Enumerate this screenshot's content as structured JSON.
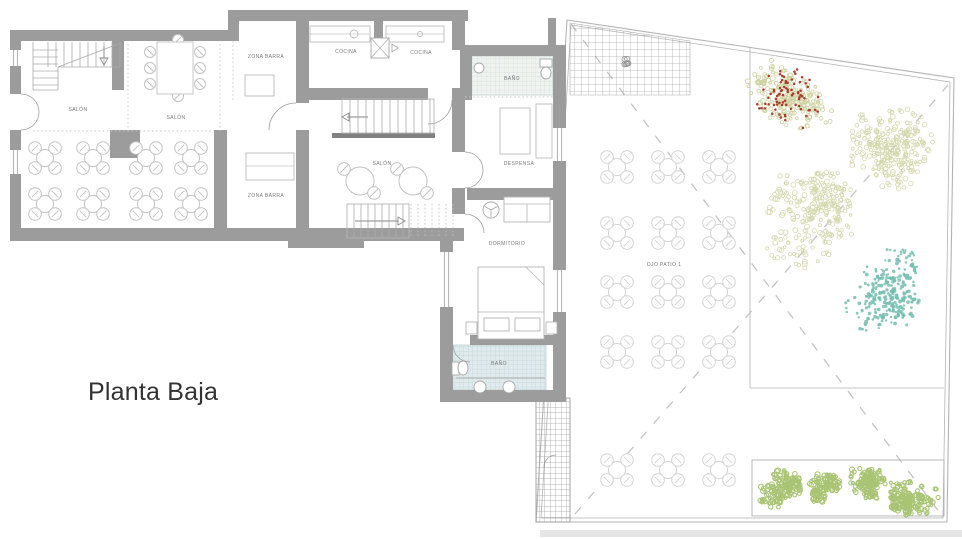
{
  "title": {
    "text": "Planta Baja"
  },
  "canvas": {
    "w": 962,
    "h": 539,
    "bg": "#ffffff"
  },
  "palette": {
    "wall": "#9c9c9c",
    "wall_dark": "#818181",
    "outline": "#b3b3b3",
    "furniture": "#c2c2c2",
    "furniture_light": "#d3d3d3",
    "label": "#787878",
    "dash": "#c3c3c3",
    "dotted": "#c6c6c6",
    "hatch": "#a5a5a5",
    "walk_hatch": "#9a9a9a",
    "tile1_bg": "#eef2f0",
    "tile1_line": "#ccd8d3",
    "tile2_bg": "#dfeaec",
    "tile2_line": "#b9cfd4",
    "band": "#e6e6e6",
    "arc": "#9f9f9f",
    "tree_olive": "#cdd2a0",
    "tree_olive_light": "#d5d9ad",
    "tree_red": "#a93a2c",
    "tree_teal": "#74bdb0",
    "bush_green": "#a9c474",
    "title_color": "#333333"
  },
  "labels": [
    {
      "text": "SALÓN",
      "x": 78,
      "y": 111
    },
    {
      "text": "SALÓN",
      "x": 176,
      "y": 119
    },
    {
      "text": "ZONA BARRA",
      "x": 266,
      "y": 58
    },
    {
      "text": "ZONA BARRA",
      "x": 266,
      "y": 197
    },
    {
      "text": "COCINA",
      "x": 346,
      "y": 53
    },
    {
      "text": "COCINA",
      "x": 421,
      "y": 54
    },
    {
      "text": "BAÑO",
      "x": 512,
      "y": 80
    },
    {
      "text": "DESPENSA",
      "x": 519,
      "y": 165
    },
    {
      "text": "SALÓN",
      "x": 382,
      "y": 165
    },
    {
      "text": "DORMITORIO",
      "x": 507,
      "y": 245
    },
    {
      "text": "BAÑO",
      "x": 499,
      "y": 365
    },
    {
      "text": "OJO PATIO 1",
      "x": 664,
      "y": 266
    }
  ],
  "building": {
    "white_areas": [
      [
        10,
        30,
        286,
        211
      ],
      [
        228,
        10,
        240,
        90
      ],
      [
        296,
        88,
        169,
        153
      ],
      [
        432,
        45,
        134,
        357
      ]
    ],
    "walls": [
      [
        10,
        30,
        221,
        11
      ],
      [
        228,
        10,
        240,
        11
      ],
      [
        228,
        10,
        11,
        31
      ],
      [
        10,
        41,
        11,
        191
      ],
      [
        10,
        228,
        285,
        13
      ],
      [
        288,
        228,
        76,
        20
      ],
      [
        112,
        41,
        12,
        49
      ],
      [
        110,
        130,
        30,
        28
      ],
      [
        214,
        130,
        13,
        98
      ],
      [
        296,
        21,
        13,
        207
      ],
      [
        374,
        10,
        9,
        31
      ],
      [
        452,
        10,
        13,
        40
      ],
      [
        300,
        88,
        162,
        12
      ],
      [
        300,
        228,
        164,
        13
      ],
      [
        452,
        95,
        13,
        57
      ],
      [
        452,
        188,
        13,
        26
      ],
      [
        460,
        45,
        106,
        11
      ],
      [
        553,
        56,
        13,
        346
      ],
      [
        460,
        56,
        12,
        44
      ],
      [
        467,
        188,
        86,
        12
      ],
      [
        440,
        232,
        13,
        170
      ],
      [
        470,
        335,
        84,
        10
      ],
      [
        440,
        390,
        126,
        12
      ],
      [
        548,
        18,
        8,
        28
      ]
    ],
    "dark_strips": [
      [
        332,
        133,
        103,
        5
      ]
    ],
    "door_gaps": [
      [
        296,
        103,
        13,
        27
      ],
      [
        428,
        88,
        24,
        12
      ],
      [
        10,
        94,
        11,
        36
      ]
    ],
    "windows": [
      {
        "r": [
          10,
          50,
          11,
          16
        ],
        "o": "v"
      },
      {
        "r": [
          10,
          150,
          11,
          24
        ],
        "o": "v"
      },
      {
        "r": [
          553,
          128,
          13,
          33
        ],
        "o": "v"
      },
      {
        "r": [
          553,
          270,
          13,
          42
        ],
        "o": "v"
      },
      {
        "r": [
          440,
          252,
          13,
          55
        ],
        "o": "v"
      }
    ],
    "door_arcs": [
      "M21,94 A18,18 0 0 1 39,112",
      "M21,130 A18,18 0 0 0 39,112",
      "M296,103 A27,27 0 0 0 269,130",
      "M452,100 A24,24 0 0 1 428,124",
      "M465,152 A18,18 0 0 1 483,170",
      "M465,188 A18,18 0 0 0 483,170",
      "M465,214 A19,19 0 0 1 484,233",
      "M453,345 A17,17 0 0 0 470,362",
      "M556,455 A12,12 0 0 0 544,467"
    ],
    "dotted_lines": [
      [
        33,
        131,
        214,
        131
      ],
      [
        128,
        44,
        128,
        131
      ],
      [
        220,
        44,
        220,
        131
      ],
      [
        233,
        41,
        233,
        100
      ],
      [
        465,
        97,
        553,
        97
      ]
    ],
    "tiles": [
      {
        "r": [
          467,
          56,
          86,
          39
        ],
        "pat": "tile1"
      },
      {
        "r": [
          452,
          345,
          94,
          45
        ],
        "pat": "tile2"
      }
    ],
    "stairs": {
      "winder": {
        "v_treads": {
          "x0": 48,
          "x1": 112,
          "step": 8,
          "y0": 42,
          "y1": 67
        },
        "h_treads": {
          "y0": 50,
          "y1": 85,
          "step": 7,
          "x0": 33,
          "x1": 58
        },
        "outline": [
          [
            33,
            42,
            33,
            90
          ],
          [
            33,
            90,
            58,
            90
          ],
          [
            58,
            67,
            58,
            90
          ],
          [
            58,
            67,
            120,
            67
          ],
          [
            120,
            42,
            120,
            67
          ]
        ],
        "diag": [
          58,
          67,
          118,
          44
        ],
        "arrow": {
          "line": [
            104,
            46,
            104,
            58
          ],
          "tri": "100,58 108,58 104,65"
        }
      },
      "upper": {
        "box": [
          342,
          99,
          92,
          34
        ],
        "treads": {
          "x0": 350,
          "x1": 430,
          "step": 8
        },
        "arrow": {
          "line": [
            347,
            117,
            368,
            117
          ],
          "tri": "349,113 349,121 342,117"
        }
      },
      "lower": {
        "box": [
          347,
          204,
          62,
          34
        ],
        "treads": {
          "x0": 354,
          "x1": 404,
          "step": 7
        },
        "dotted": {
          "x0": 411,
          "x1": 453,
          "step": 7,
          "y0": 204,
          "y1": 238
        },
        "arrow": {
          "line": [
            355,
            221,
            398,
            221
          ],
          "tri": "398,217 398,225 405,221"
        }
      }
    },
    "furniture": {
      "tables4_indoor": [
        [
          45,
          158
        ],
        [
          93,
          158
        ],
        [
          146,
          158
        ],
        [
          191,
          158
        ],
        [
          45,
          204
        ],
        [
          93,
          204
        ],
        [
          146,
          204
        ],
        [
          191,
          204
        ]
      ],
      "tables2": [
        [
          360,
          181
        ],
        [
          413,
          181
        ]
      ],
      "long_table": {
        "rect": [
          157,
          42,
          36,
          52
        ],
        "chairs_left_x": 150,
        "chairs_right_x": 200,
        "chairs_y": [
          52,
          68,
          84
        ],
        "end_chairs": [
          [
            178,
            40
          ],
          [
            178,
            96
          ]
        ]
      },
      "counters": [
        [
          245,
          75,
          29,
          21
        ],
        [
          246,
          153,
          48,
          27
        ],
        [
          310,
          26,
          60,
          16
        ],
        [
          386,
          26,
          58,
          16
        ],
        [
          500,
          108,
          30,
          46
        ],
        [
          536,
          104,
          16,
          54
        ]
      ],
      "counter_lines": [
        [
          246,
          166,
          294,
          166
        ],
        [
          310,
          34,
          370,
          34
        ],
        [
          386,
          34,
          444,
          34
        ]
      ],
      "appliances": [
        {
          "c": [
            354,
            34
          ],
          "r": 4
        },
        {
          "c": [
            420,
            34
          ],
          "r": 2.5
        }
      ],
      "door_icon": {
        "rect": [
          371,
          38,
          18,
          20
        ],
        "x1": [
          371,
          38,
          389,
          58
        ],
        "x2": [
          389,
          38,
          371,
          58
        ],
        "tri": "392,44 398,48 392,52"
      },
      "bed": {
        "rect": [
          478,
          267,
          66,
          72
        ],
        "pillows": [
          [
            484,
            318,
            25,
            13
          ],
          [
            515,
            318,
            25,
            13
          ]
        ],
        "line": [
          478,
          312,
          544,
          312
        ],
        "fold": [
          526,
          267,
          544,
          285
        ],
        "stands": [
          [
            466,
            322,
            11,
            12
          ],
          [
            546,
            322,
            11,
            12
          ]
        ]
      },
      "sofa": {
        "rect": [
          504,
          197,
          46,
          25
        ],
        "back": [
          504,
          204,
          550,
          204
        ],
        "split": [
          527,
          204,
          527,
          222
        ]
      },
      "fan": {
        "c": [
          491,
          210
        ],
        "r": 8
      },
      "bath1": {
        "sink": {
          "c": [
            479,
            68
          ],
          "r": 5
        },
        "toilet_tank": [
          540,
          59,
          12,
          8
        ],
        "toilet_bowl": {
          "c": [
            546,
            73
          ],
          "rx": 5,
          "ry": 6
        }
      },
      "bath2": {
        "counter": [
          456,
          378,
          545,
          378
        ],
        "sinks": [
          [
            480,
            387
          ],
          [
            509,
            387
          ]
        ],
        "toilet_tank": [
          452,
          362,
          7,
          13
        ],
        "toilet_bowl": {
          "c": [
            463,
            368
          ],
          "rx": 5,
          "ry": 7
        }
      }
    }
  },
  "patio": {
    "outline_outer": "567,20 954,78 947,522 536,522",
    "outline_inner": "571,25 950,82 943,518 541,518",
    "garden_lines": [
      [
        750,
        47,
        750,
        388
      ],
      [
        750,
        388,
        944,
        388
      ]
    ],
    "dash_lines": [
      [
        571,
        24,
        943,
        517
      ],
      [
        575,
        514,
        948,
        85
      ]
    ],
    "terrace_hatch": "570,23 690,41 690,95 570,95",
    "flower": {
      "c": [
        628,
        62
      ],
      "r": 7
    },
    "walkway": [
      536,
      398,
      34,
      124
    ],
    "planter": [
      752,
      460,
      192,
      56
    ],
    "bottom_band": [
      540,
      530,
      422,
      7
    ],
    "table_cols": [
      617,
      668,
      719
    ],
    "table_rows": [
      167,
      233,
      292,
      352,
      470
    ]
  },
  "trees": [
    {
      "cx": 790,
      "cy": 100,
      "r": 46,
      "type": "mixed",
      "seed": 7
    },
    {
      "cx": 894,
      "cy": 148,
      "r": 54,
      "type": "ring",
      "seed": 11
    },
    {
      "cx": 812,
      "cy": 220,
      "r": 54,
      "type": "ring",
      "seed": 23
    },
    {
      "cx": 886,
      "cy": 290,
      "r": 48,
      "type": "dots",
      "seed": 31
    }
  ],
  "bushes": [
    {
      "cx": 781,
      "cy": 487,
      "r": 25,
      "seed": 41
    },
    {
      "cx": 823,
      "cy": 489,
      "r": 18,
      "seed": 43
    },
    {
      "cx": 869,
      "cy": 486,
      "r": 23,
      "seed": 47
    },
    {
      "cx": 914,
      "cy": 490,
      "r": 28,
      "seed": 53
    }
  ]
}
